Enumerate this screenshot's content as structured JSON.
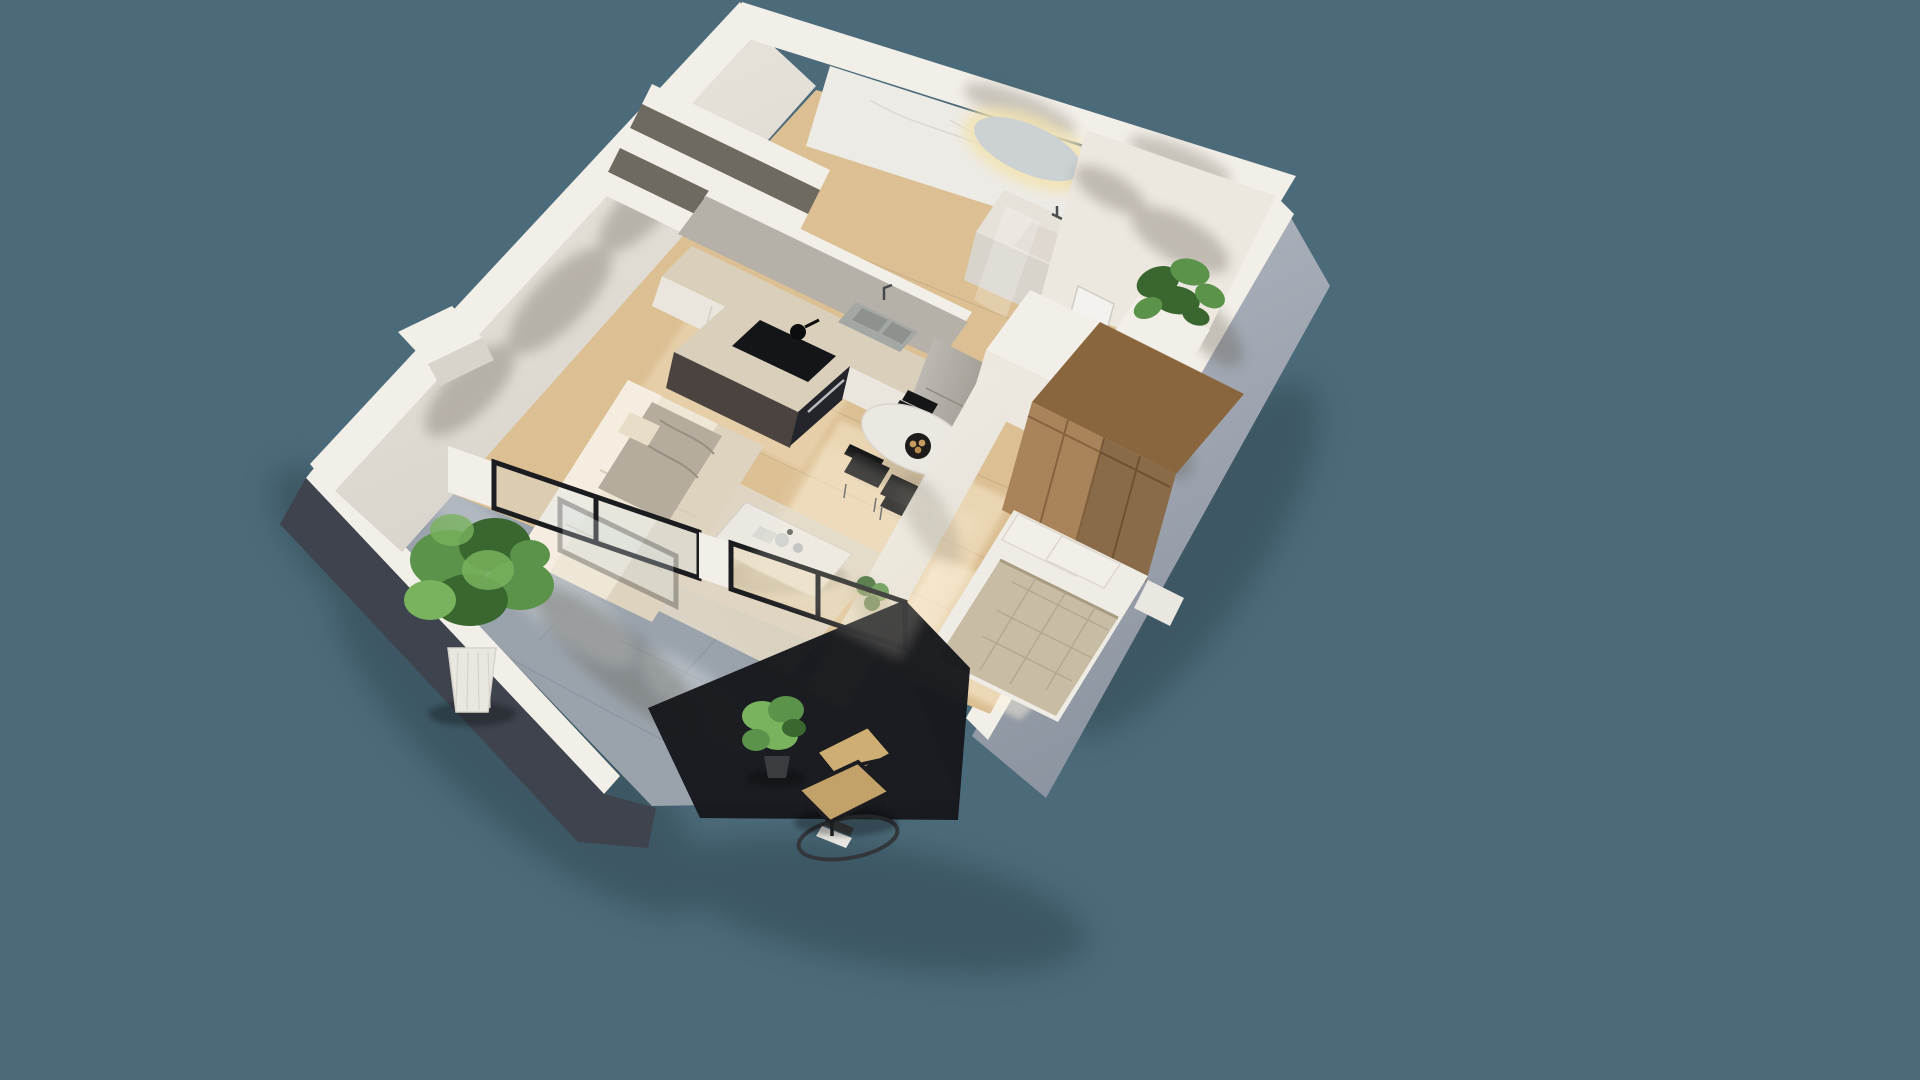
{
  "meta": {
    "description": "3D isometric cutaway render of a one-bedroom apartment floor plan with balcony, viewed from above on a teal background"
  },
  "canvas": {
    "width": 1920,
    "height": 1080,
    "background": "#4c6b7a"
  },
  "palette": {
    "background": "#4c6b7a",
    "ground_shadow": "#2e4450",
    "wall_white": "#f2efe8",
    "wall_cream": "#ece7df",
    "wall_shade": "#d8d4cc",
    "wall_gray": "#b2b8c1",
    "wall_gray_dark": "#8b93a0",
    "parapet_dark": "#3e434d",
    "shadow_mass": "#16181c",
    "concrete": "#b5b0a8",
    "marble": "#edebe6",
    "floor_wood": "#dcc094",
    "rug": "#ded6c4",
    "terrace_tile": "#9aa3ac",
    "terrace_light": "#c9ced4",
    "counter_top": "#d9cfbb",
    "cabinet_front": "#eae6de",
    "appliance_black": "#141518",
    "oven_dark": "#23252a",
    "sofa_cream": "#efe7d6",
    "sofa_light": "#f5eee0",
    "sofa_shade": "#ded3bf",
    "throw_gray": "#b5ac9e",
    "pillow": "#e8ddc6",
    "table_white": "#ebe8e2",
    "chair_black": "#1c1d1f",
    "bed_white": "#efece5",
    "quilt_beige": "#c8bca4",
    "wardrobe_wood": "#a9835a",
    "wardrobe_wood_dark": "#8a663f",
    "plant_green": "#5a9349",
    "plant_green_dark": "#39672f",
    "plant_green_light": "#79b35e",
    "pot_white": "#e9e7e0",
    "cane": "#c3a26a",
    "frame_black": "#1b1c1f",
    "door_white": "#f4f2ee",
    "mirror_glass": "#ccd2d3",
    "glow_warm": "#f3e3b2",
    "sun_patch": "#fff6e0",
    "leaf_shadow": "#5b5548",
    "niche_dark": "#6f6a60",
    "vanity_top": "#e7e2d9",
    "basin": "#ded8cf",
    "sink_steel": "#a3a8a4",
    "peninsula_dark": "#4a433f"
  },
  "scene": {
    "rooms": [
      {
        "name": "bathroom"
      },
      {
        "name": "kitchen"
      },
      {
        "name": "dining-area"
      },
      {
        "name": "living-area"
      },
      {
        "name": "bedroom"
      },
      {
        "name": "entry-hall"
      },
      {
        "name": "balcony-terrace"
      }
    ],
    "objects": [
      {
        "name": "backlit-mirror"
      },
      {
        "name": "vanity-sink"
      },
      {
        "name": "washing-machine"
      },
      {
        "name": "kitchen-counter"
      },
      {
        "name": "double-sink"
      },
      {
        "name": "cooktop-with-pot"
      },
      {
        "name": "built-in-oven"
      },
      {
        "name": "fridge"
      },
      {
        "name": "oval-dining-table"
      },
      {
        "name": "fruit-bowl"
      },
      {
        "name": "dining-chairs"
      },
      {
        "name": "cream-sofa"
      },
      {
        "name": "gray-throw"
      },
      {
        "name": "coffee-table"
      },
      {
        "name": "partition-wall"
      },
      {
        "name": "double-bed"
      },
      {
        "name": "nightstand"
      },
      {
        "name": "wooden-wardrobe"
      },
      {
        "name": "white-closet"
      },
      {
        "name": "entry-door"
      },
      {
        "name": "monstera-plant"
      },
      {
        "name": "large-potted-tree"
      },
      {
        "name": "small-potted-plant"
      },
      {
        "name": "cane-lounge-chair"
      },
      {
        "name": "round-glass-table"
      },
      {
        "name": "sliding-glass-doors"
      },
      {
        "name": "tiled-terrace-floor"
      }
    ]
  }
}
